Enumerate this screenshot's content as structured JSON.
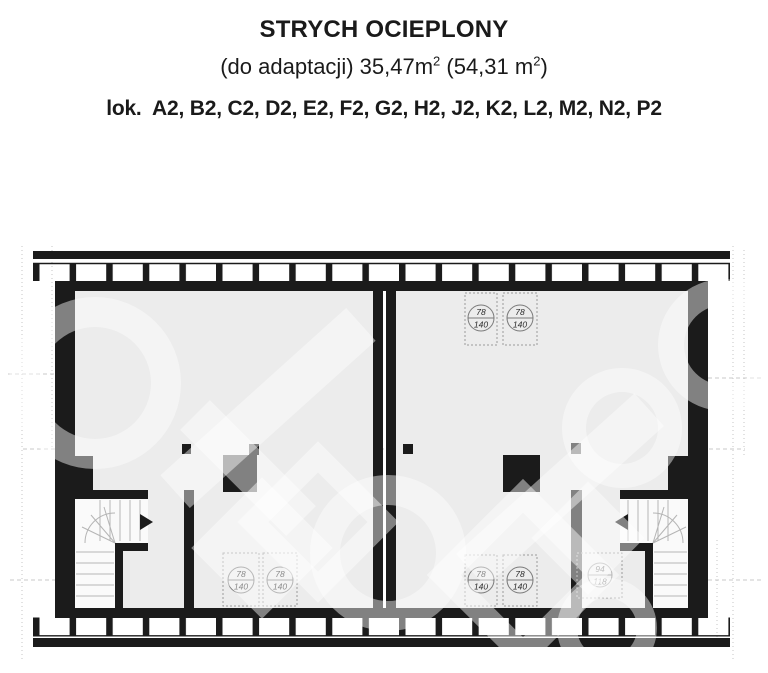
{
  "header": {
    "title": "STRYCH OCIEPLONY",
    "area_prefix": "(do adaptacji) 35,47m",
    "area_sup1": "2",
    "area_mid": " (54,31 m",
    "area_sup2": "2",
    "area_suffix": ")",
    "locations": "lok.  A2, B2, C2, D2, E2, F2, G2, H2, J2, K2, L2, M2, N2, P2"
  },
  "plan": {
    "colors": {
      "wall": "#1b1b1b",
      "room": "#ececec",
      "stair_area": "#fafafa"
    },
    "windows": {
      "top_right_1": {
        "num": "78",
        "den": "140"
      },
      "top_right_2": {
        "num": "78",
        "den": "140"
      },
      "bottom_left_1": {
        "num": "78",
        "den": "140"
      },
      "bottom_left_2": {
        "num": "78",
        "den": "140"
      },
      "bottom_right_1": {
        "num": "78",
        "den": "140"
      },
      "bottom_right_2": {
        "num": "78",
        "den": "140"
      },
      "bottom_right_3": {
        "num": "94",
        "den": "118"
      }
    }
  }
}
